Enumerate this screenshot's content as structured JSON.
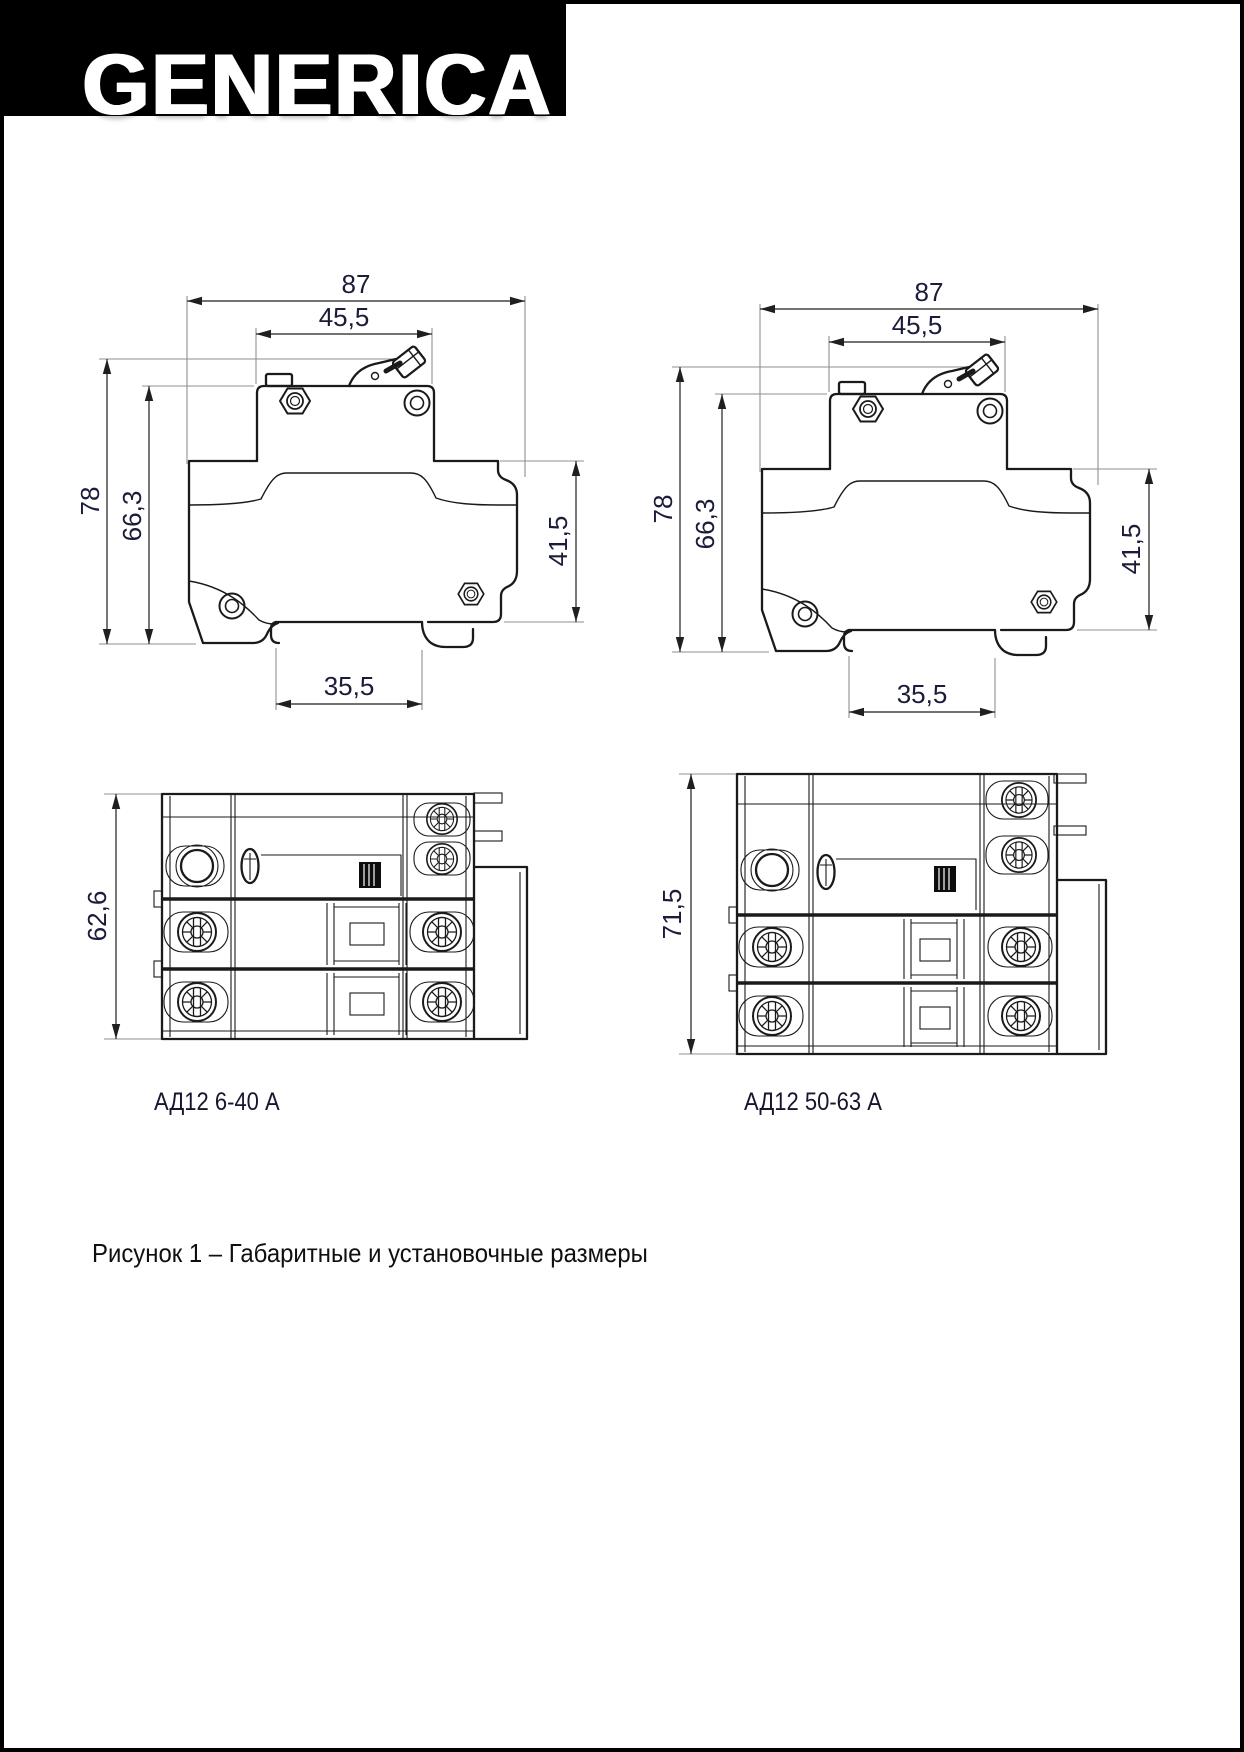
{
  "logo": {
    "text": "GENERICA"
  },
  "figures": {
    "top_left": {
      "width_overall": "87",
      "width_top": "45,5",
      "height_overall": "78",
      "height_body": "66,3",
      "height_right": "41,5",
      "width_foot": "35,5"
    },
    "top_right": {
      "width_overall": "87",
      "width_top": "45,5",
      "height_overall": "78",
      "height_body": "66,3",
      "height_right": "41,5",
      "width_foot": "35,5"
    },
    "bottom_left": {
      "height_overall": "62,6",
      "label": "АД12 6-40 А"
    },
    "bottom_right": {
      "height_overall": "71,5",
      "label": "АД12 50-63 А"
    }
  },
  "caption": "Рисунок 1 – Габаритные и установочные размеры",
  "colors": {
    "page_border": "#000000",
    "logo_bg": "#000000",
    "logo_text": "#ffffff",
    "drawing_line": "#1a1a1a",
    "dimension_text": "#1b1b3a"
  }
}
